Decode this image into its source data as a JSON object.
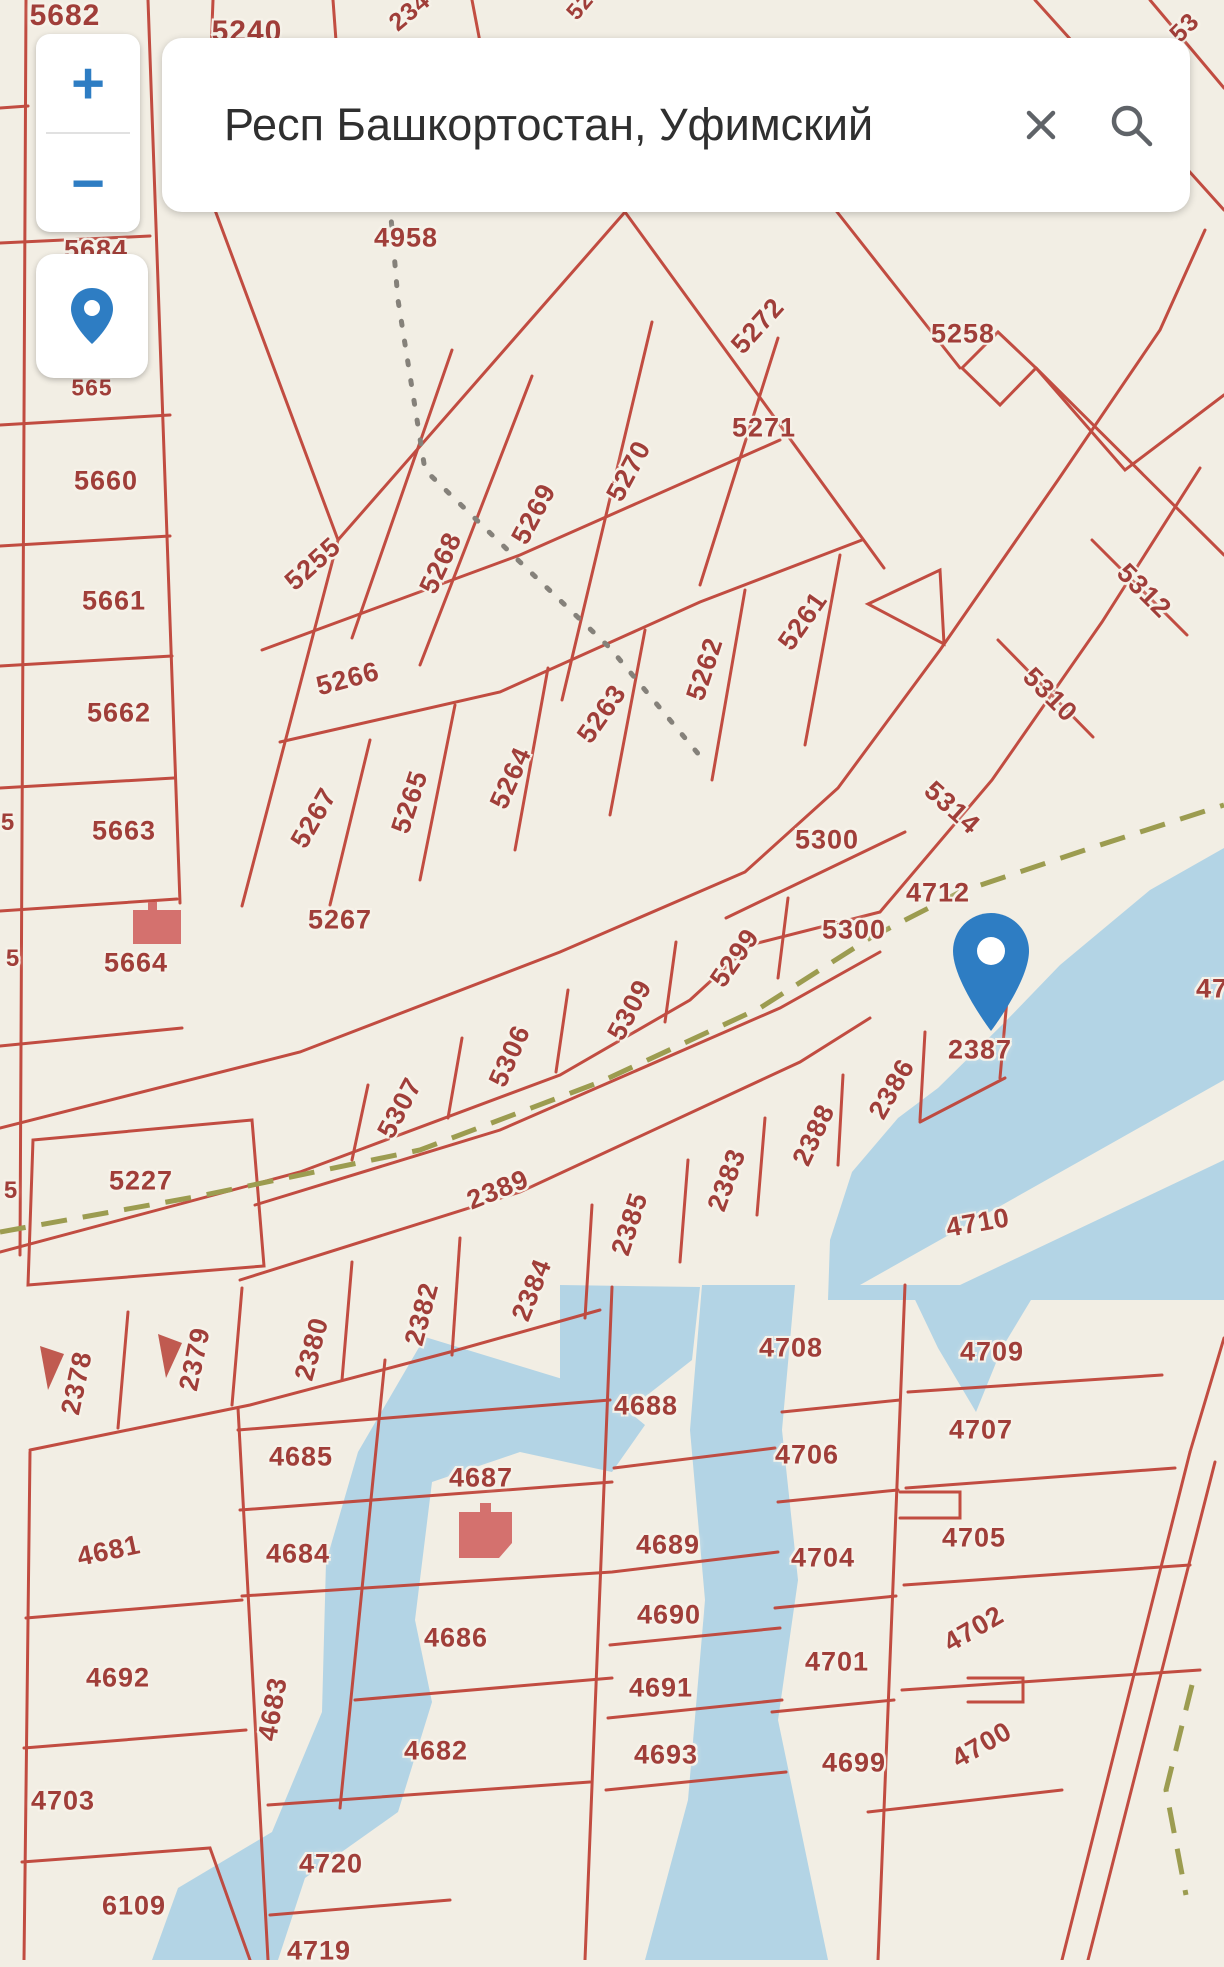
{
  "app": {
    "type": "cadastral-map-viewer"
  },
  "search": {
    "value": "Респ Башкортостан, Уфимский"
  },
  "controls": {
    "zoom_in": "+",
    "zoom_out": "−"
  },
  "marker": {
    "parcel": "2387"
  },
  "colors": {
    "map_background": "#f2eee4",
    "parcel_line": "#bf4439",
    "parcel_label": "#a03e39",
    "water": "#b3d4e5",
    "path_dashed": "#9c9c50",
    "accent_blue": "#2e7dc3",
    "building_icon": "#d4716e"
  },
  "map": {
    "parcels": [
      {
        "id": "5682",
        "x": 65,
        "y": 16,
        "rot": 0,
        "size": 30
      },
      {
        "id": "5240",
        "x": 247,
        "y": 32,
        "rot": 0,
        "size": 30
      },
      {
        "id": "234",
        "x": 410,
        "y": 12,
        "rot": -40,
        "size": 25,
        "partial": true
      },
      {
        "id": "52",
        "x": 580,
        "y": 6,
        "rot": -50,
        "size": 23,
        "partial": true
      },
      {
        "id": "53",
        "x": 1185,
        "y": 28,
        "rot": -45,
        "size": 25,
        "partial": true
      },
      {
        "id": "5684",
        "x": 96,
        "y": 250,
        "rot": 0
      },
      {
        "id": "565",
        "x": 92,
        "y": 388,
        "rot": 0,
        "size": 23,
        "partial": true
      },
      {
        "id": "5660",
        "x": 106,
        "y": 481,
        "rot": 0
      },
      {
        "id": "5661",
        "x": 114,
        "y": 601,
        "rot": 0
      },
      {
        "id": "5662",
        "x": 119,
        "y": 713,
        "rot": 0
      },
      {
        "id": "5663",
        "x": 124,
        "y": 831,
        "rot": 0
      },
      {
        "id": "5664",
        "x": 136,
        "y": 963,
        "rot": 0
      },
      {
        "id": "5227",
        "x": 141,
        "y": 1181,
        "rot": 0
      },
      {
        "id": "5",
        "x": 8,
        "y": 823,
        "rot": 0,
        "size": 24,
        "partial": true
      },
      {
        "id": "5",
        "x": 13,
        "y": 959,
        "rot": 0,
        "size": 24,
        "partial": true
      },
      {
        "id": "5",
        "x": 11,
        "y": 1191,
        "rot": 0,
        "size": 24,
        "partial": true
      },
      {
        "id": "4958",
        "x": 406,
        "y": 238,
        "rot": 0
      },
      {
        "id": "273",
        "x": 701,
        "y": 181,
        "rot": -50,
        "partial": true
      },
      {
        "id": "5272",
        "x": 758,
        "y": 326,
        "rot": -48
      },
      {
        "id": "5258",
        "x": 963,
        "y": 334,
        "rot": 0
      },
      {
        "id": "5271",
        "x": 764,
        "y": 428,
        "rot": 0
      },
      {
        "id": "5270",
        "x": 629,
        "y": 471,
        "rot": -62
      },
      {
        "id": "5269",
        "x": 534,
        "y": 514,
        "rot": -62
      },
      {
        "id": "5268",
        "x": 441,
        "y": 563,
        "rot": -65
      },
      {
        "id": "5255",
        "x": 313,
        "y": 564,
        "rot": -42
      },
      {
        "id": "5266",
        "x": 348,
        "y": 679,
        "rot": -15
      },
      {
        "id": "5261",
        "x": 803,
        "y": 621,
        "rot": -55
      },
      {
        "id": "5262",
        "x": 705,
        "y": 669,
        "rot": -72
      },
      {
        "id": "5263",
        "x": 602,
        "y": 714,
        "rot": -55
      },
      {
        "id": "5264",
        "x": 511,
        "y": 778,
        "rot": -66
      },
      {
        "id": "5265",
        "x": 410,
        "y": 802,
        "rot": -72
      },
      {
        "id": "5267",
        "x": 314,
        "y": 818,
        "rot": -60
      },
      {
        "id": "5267",
        "x": 340,
        "y": 920,
        "rot": 0
      },
      {
        "id": "5312",
        "x": 1144,
        "y": 591,
        "rot": 45
      },
      {
        "id": "5310",
        "x": 1050,
        "y": 695,
        "rot": 45
      },
      {
        "id": "5314",
        "x": 952,
        "y": 808,
        "rot": 42
      },
      {
        "id": "5300",
        "x": 827,
        "y": 840,
        "rot": 0
      },
      {
        "id": "5300",
        "x": 854,
        "y": 930,
        "rot": 0
      },
      {
        "id": "5299",
        "x": 735,
        "y": 958,
        "rot": -55
      },
      {
        "id": "5309",
        "x": 630,
        "y": 1010,
        "rot": -62
      },
      {
        "id": "5306",
        "x": 510,
        "y": 1056,
        "rot": -66
      },
      {
        "id": "5307",
        "x": 400,
        "y": 1108,
        "rot": -62
      },
      {
        "id": "2389",
        "x": 498,
        "y": 1190,
        "rot": -22
      },
      {
        "id": "2387",
        "x": 980,
        "y": 1050,
        "rot": 0
      },
      {
        "id": "2386",
        "x": 892,
        "y": 1089,
        "rot": -60
      },
      {
        "id": "2388",
        "x": 814,
        "y": 1135,
        "rot": -65
      },
      {
        "id": "2383",
        "x": 727,
        "y": 1180,
        "rot": -70
      },
      {
        "id": "2385",
        "x": 630,
        "y": 1224,
        "rot": -72
      },
      {
        "id": "2384",
        "x": 532,
        "y": 1290,
        "rot": -68
      },
      {
        "id": "2382",
        "x": 422,
        "y": 1314,
        "rot": -75
      },
      {
        "id": "2380",
        "x": 312,
        "y": 1349,
        "rot": -75
      },
      {
        "id": "2379",
        "x": 195,
        "y": 1359,
        "rot": -78
      },
      {
        "id": "2378",
        "x": 77,
        "y": 1383,
        "rot": -78
      },
      {
        "id": "4712",
        "x": 938,
        "y": 893,
        "rot": 0
      },
      {
        "id": "47",
        "x": 1212,
        "y": 989,
        "rot": 0,
        "partial": true
      },
      {
        "id": "4710",
        "x": 978,
        "y": 1223,
        "rot": -10
      },
      {
        "id": "4708",
        "x": 791,
        "y": 1348,
        "rot": 0
      },
      {
        "id": "4709",
        "x": 992,
        "y": 1352,
        "rot": 0
      },
      {
        "id": "4688",
        "x": 646,
        "y": 1406,
        "rot": 0
      },
      {
        "id": "4707",
        "x": 981,
        "y": 1430,
        "rot": 0
      },
      {
        "id": "4706",
        "x": 807,
        "y": 1455,
        "rot": 0
      },
      {
        "id": "4685",
        "x": 301,
        "y": 1457,
        "rot": 0
      },
      {
        "id": "4687",
        "x": 481,
        "y": 1478,
        "rot": 0
      },
      {
        "id": "4689",
        "x": 668,
        "y": 1545,
        "rot": 0
      },
      {
        "id": "4705",
        "x": 974,
        "y": 1538,
        "rot": 0
      },
      {
        "id": "4684",
        "x": 298,
        "y": 1554,
        "rot": 0
      },
      {
        "id": "4704",
        "x": 823,
        "y": 1558,
        "rot": 0
      },
      {
        "id": "4681",
        "x": 109,
        "y": 1551,
        "rot": -12
      },
      {
        "id": "4690",
        "x": 669,
        "y": 1615,
        "rot": 0
      },
      {
        "id": "4702",
        "x": 974,
        "y": 1629,
        "rot": -30
      },
      {
        "id": "4686",
        "x": 456,
        "y": 1638,
        "rot": 0
      },
      {
        "id": "4701",
        "x": 837,
        "y": 1662,
        "rot": 0
      },
      {
        "id": "4692",
        "x": 118,
        "y": 1678,
        "rot": 0
      },
      {
        "id": "4691",
        "x": 661,
        "y": 1688,
        "rot": 0
      },
      {
        "id": "4683",
        "x": 273,
        "y": 1709,
        "rot": -80
      },
      {
        "id": "4700",
        "x": 982,
        "y": 1745,
        "rot": -30
      },
      {
        "id": "4682",
        "x": 436,
        "y": 1751,
        "rot": 0
      },
      {
        "id": "4693",
        "x": 666,
        "y": 1755,
        "rot": 0
      },
      {
        "id": "4699",
        "x": 854,
        "y": 1763,
        "rot": 0
      },
      {
        "id": "4703",
        "x": 63,
        "y": 1801,
        "rot": 0
      },
      {
        "id": "4720",
        "x": 331,
        "y": 1864,
        "rot": 0
      },
      {
        "id": "6109",
        "x": 134,
        "y": 1906,
        "rot": 0
      },
      {
        "id": "4719",
        "x": 319,
        "y": 1951,
        "rot": 0
      }
    ]
  }
}
